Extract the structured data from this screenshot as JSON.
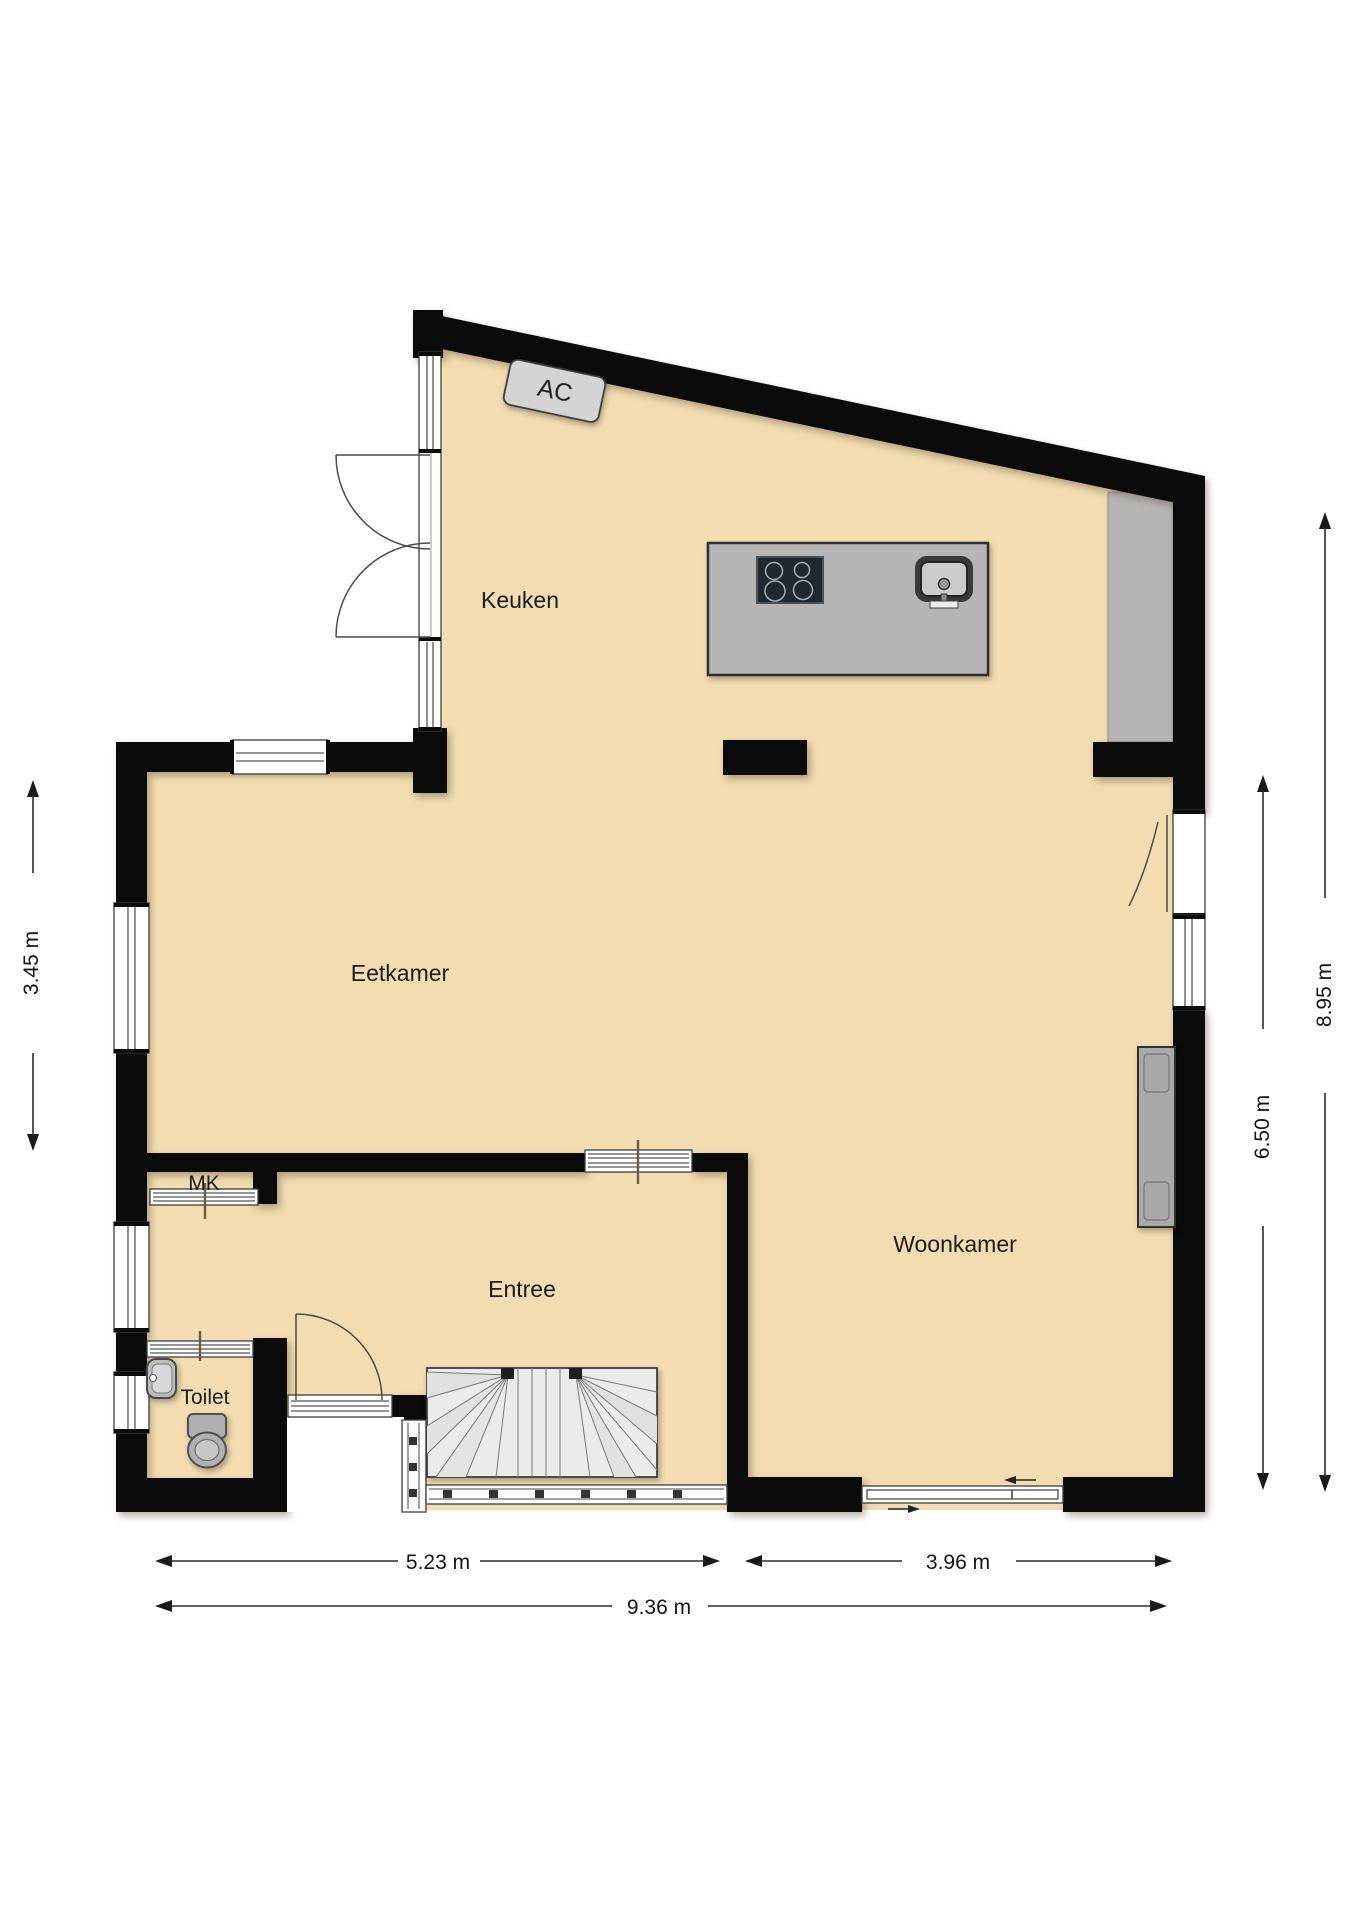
{
  "labels": {
    "keuken": "Keuken",
    "eetkamer": "Eetkamer",
    "woonkamer": "Woonkamer",
    "entree": "Entree",
    "toilet": "Toilet",
    "mk": "MK",
    "ac": "AC"
  },
  "dimensions": {
    "left": "3.45 m",
    "right_outer": "8.95 m",
    "right_inner": "6.50 m",
    "bottom_left": "5.23 m",
    "bottom_right": "3.96 m",
    "bottom_total": "9.36 m"
  },
  "colors": {
    "floor": "#f2dcb0",
    "wall": "#0b0b0b",
    "fixture": "#b5b5b5",
    "counter": "#b5b5b5",
    "stair": "#ebebeb",
    "radiator": "#a9a9a9",
    "ac_box": "#d4d4d4",
    "dimension": "#1a1a1a"
  }
}
